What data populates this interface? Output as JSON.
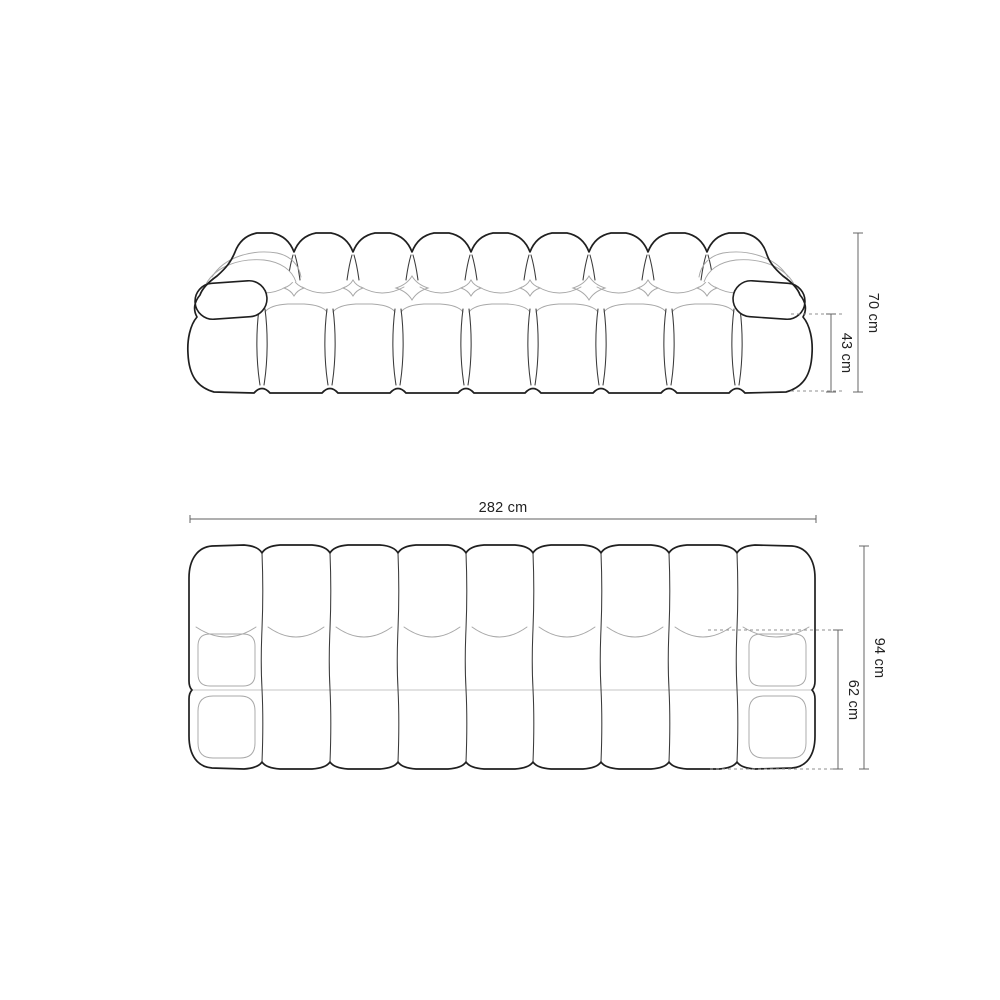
{
  "figure": {
    "type": "sofa-dimension-diagram",
    "views": {
      "front": {
        "name": "front-view",
        "dimensions": {
          "height_total": "70 cm",
          "height_seat": "43 cm"
        }
      },
      "top": {
        "name": "top-view",
        "dimensions": {
          "width_total": "282 cm",
          "depth_total": "94 cm",
          "depth_seat": "62 cm"
        }
      }
    },
    "colors": {
      "background": "#ffffff",
      "outline_dark": "#1f1f1f",
      "outline_light": "#a8a8a8",
      "dimension_line": "#5f5f5f",
      "dashed_line": "#8f8f8f",
      "label_text": "#222222"
    }
  }
}
